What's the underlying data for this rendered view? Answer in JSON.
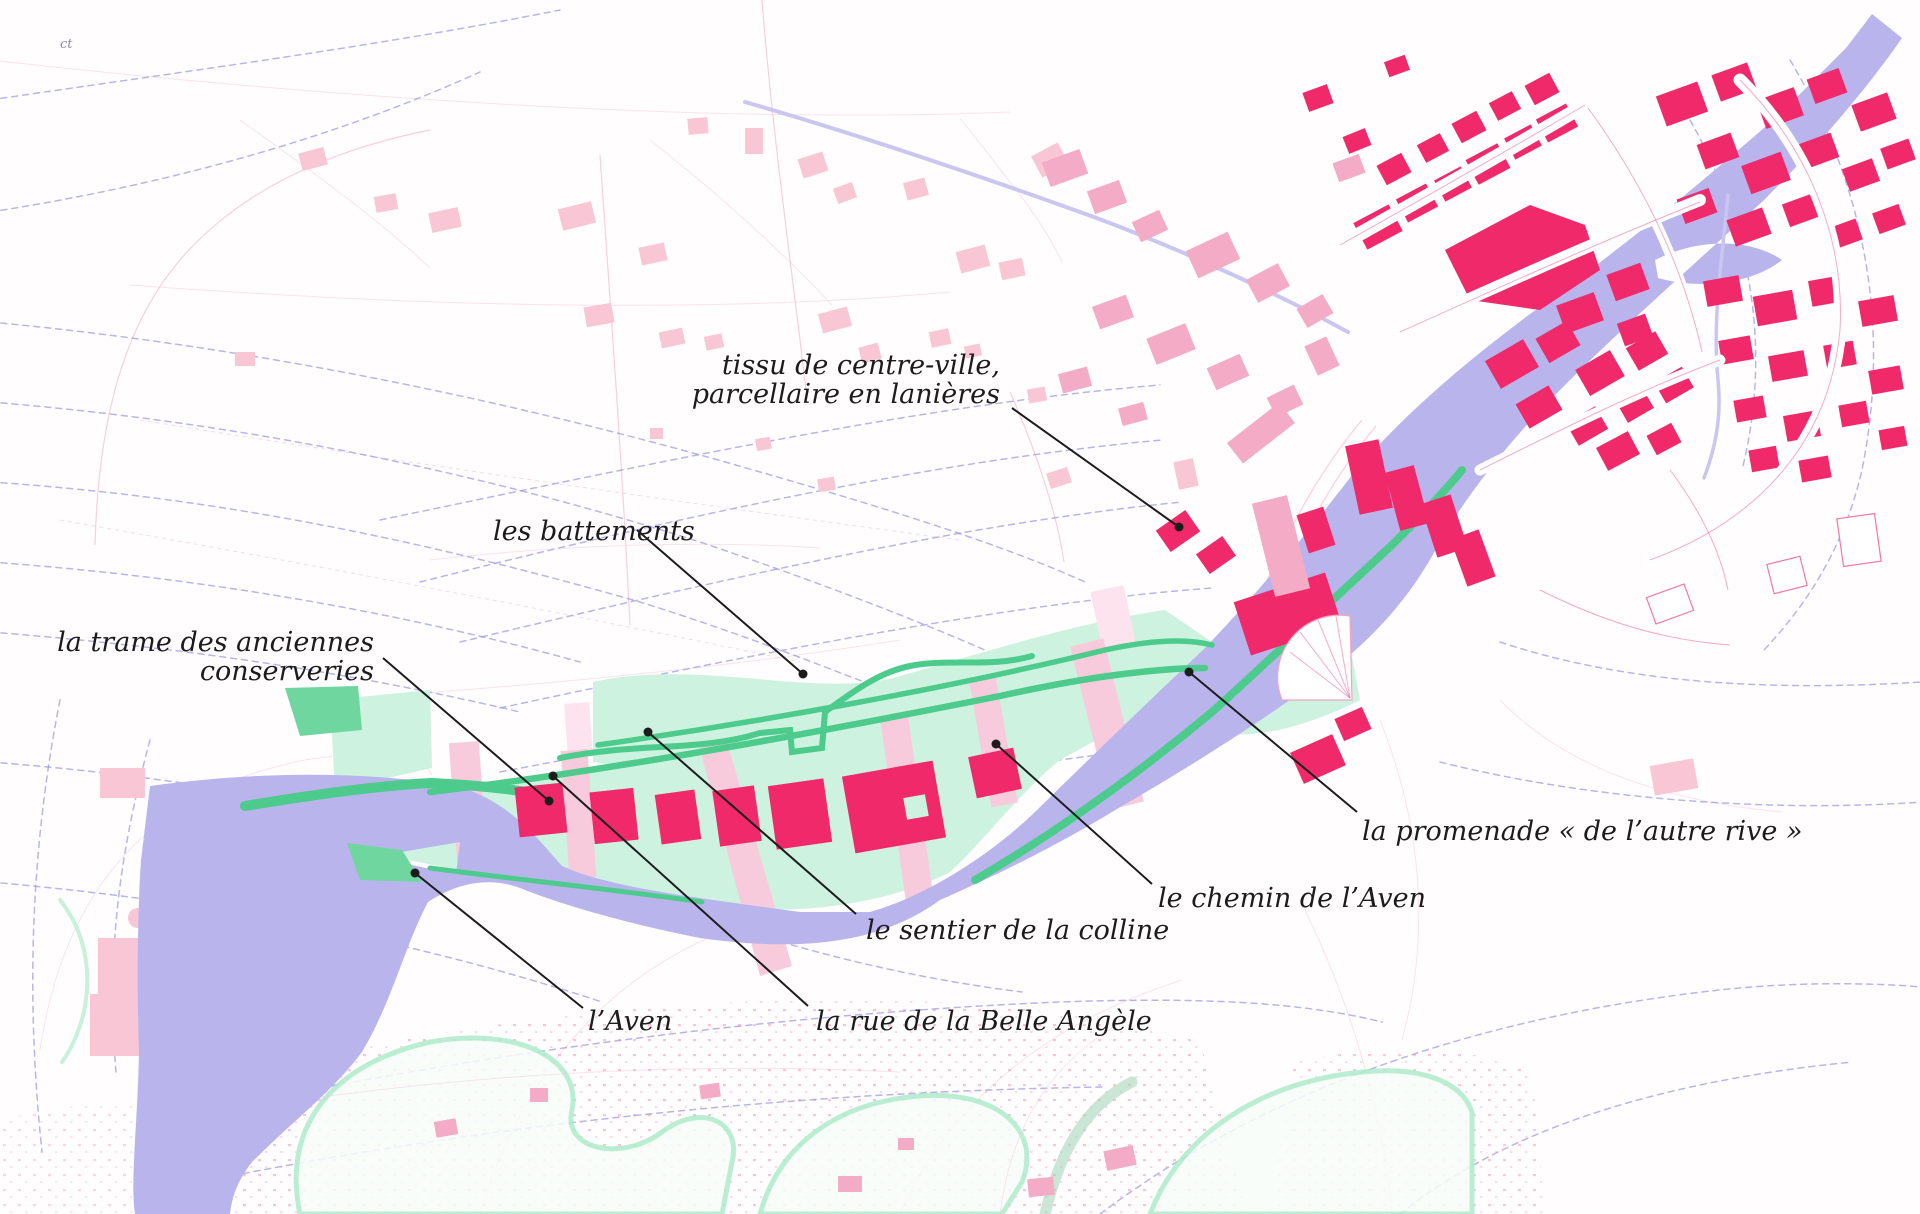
{
  "map": {
    "type": "annotated-urban-analysis-map",
    "corner_mark": "ct",
    "annotations": {
      "tissu": {
        "line1": "tissu de centre-ville,",
        "line2": "parcellaire en lanières"
      },
      "battements": {
        "label": "les battements"
      },
      "trame": {
        "line1": "la trame des anciennes",
        "line2": "conserveries"
      },
      "promenade": {
        "label": "la promenade « de l’autre rive »"
      },
      "chemin": {
        "label": "le chemin de l’Aven"
      },
      "sentier": {
        "label": "le sentier de la colline"
      },
      "rue": {
        "label": "la rue de la Belle Angèle"
      },
      "aven": {
        "label": "l’Aven"
      }
    },
    "features": {
      "river-name": "l’Aven",
      "green-zone": "trame des anciennes conserveries",
      "town": "tissu de centre-ville"
    }
  },
  "palette": {
    "bg": "#fffdfe",
    "ink": "#1c1c1c",
    "river": "#b9b5ec",
    "contour": "#8d92dc",
    "parcel": "#f6c3d4",
    "pale": "#f8c6d5",
    "midpink": "#f4abc6",
    "red": "#f0296b",
    "mint": "#cdf2df",
    "strip": "#f8cbdc",
    "green": "#4ccb8c"
  }
}
